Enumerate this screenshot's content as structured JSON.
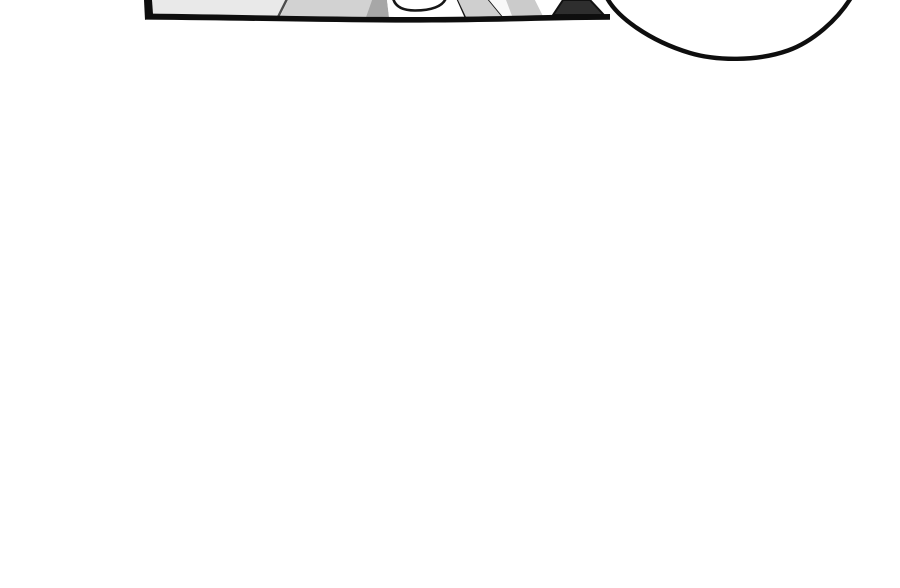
{
  "canvas": {
    "width": 900,
    "height": 588,
    "background": "#ffffff"
  },
  "palette": {
    "ink": "#0e0e0e",
    "floor_light_gray": "#e9e9e9",
    "floor_mid_gray": "#d2d2d2",
    "shadow_gray": "#a7a7a7",
    "strut_gray": "#cfcfcf",
    "wedge_dark": "#2e2e2e",
    "bubble_fill": "#ffffff"
  },
  "comic": {
    "panel_fragment": {
      "shapes": [
        {
          "name": "floor-panel-light",
          "tag": "polygon",
          "attrs": {
            "points": "151,0 288,0 280,17 151,17",
            "fill": "#e9e9e9"
          }
        },
        {
          "name": "floor-seam-line",
          "tag": "line",
          "attrs": {
            "x1": 287,
            "y1": -1,
            "x2": 278,
            "y2": 17,
            "stroke": "#4d4d4d",
            "stroke-width": 2.4
          }
        },
        {
          "name": "floor-panel-mid",
          "tag": "polygon",
          "attrs": {
            "points": "288,0 372,0 366,17 280,17",
            "fill": "#d2d2d2"
          }
        },
        {
          "name": "shadow-patch",
          "tag": "polygon",
          "attrs": {
            "points": "372,0 387,0 389,17 366,17",
            "fill": "#a7a7a7"
          }
        },
        {
          "name": "white-object-area",
          "tag": "polygon",
          "attrs": {
            "points": "387,0 458,0 466,17 389,17",
            "fill": "#ffffff"
          }
        },
        {
          "name": "round-object-bottom-arc",
          "tag": "path",
          "attrs": {
            "d": "M393,-2 C395,7 403,10.5 415,10.5 C431,10.5 443,6.5 446,-2",
            "fill": "none",
            "stroke": "#161616",
            "stroke-width": 2.6,
            "stroke-linecap": "round"
          }
        },
        {
          "name": "diagonal-edge-left",
          "tag": "line",
          "attrs": {
            "x1": 458,
            "y1": -1,
            "x2": 466,
            "y2": 17,
            "stroke": "#161616",
            "stroke-width": 3
          }
        },
        {
          "name": "gray-strut-left",
          "tag": "polygon",
          "attrs": {
            "points": "458,0 489,0 503,17 466,17",
            "fill": "#cfcfcf"
          }
        },
        {
          "name": "diagonal-edge-right",
          "tag": "line",
          "attrs": {
            "x1": 489,
            "y1": -1,
            "x2": 503,
            "y2": 16,
            "stroke": "#161616",
            "stroke-width": 3
          }
        },
        {
          "name": "white-sliver",
          "tag": "polygon",
          "attrs": {
            "points": "489,0 506,0 512,17 503,17",
            "fill": "#f8f8f8"
          }
        },
        {
          "name": "gray-strut-right",
          "tag": "polygon",
          "attrs": {
            "points": "506,0 535,0 543,16 512,16",
            "fill": "#cbcbcb"
          }
        },
        {
          "name": "white-gap",
          "tag": "polygon",
          "attrs": {
            "points": "535,0 563,0 553,16 543,16",
            "fill": "#ffffff"
          }
        },
        {
          "name": "dark-wedge",
          "tag": "polygon",
          "attrs": {
            "points": "563,0 590,0 604,15 553,15",
            "fill": "#2e2e2e",
            "stroke": "#111111",
            "stroke-width": 2,
            "stroke-linejoin": "round"
          }
        },
        {
          "name": "panel-border-bottom",
          "tag": "path",
          "attrs": {
            "d": "M145,13.5 C260,15 340,17.2 420,17 C500,16.8 556,14.2 610,14 L610,19.8 C556,20 500,22.4 420,22.6 C340,22.8 260,20.6 145,19.6 Z",
            "fill": "#0e0e0e"
          }
        },
        {
          "name": "panel-border-left",
          "tag": "polygon",
          "attrs": {
            "points": "144,0 152,0 153,14 145,20",
            "fill": "#0e0e0e"
          }
        }
      ]
    },
    "speech_bubble": {
      "path": "M606,-4 C616,17 650,41 690,53 C716,60.8 757,61.5 788,50.5 C812,42 838,20 852,-4 Z",
      "fill": "#ffffff",
      "stroke": "#0e0e0e",
      "stroke_width": 4.4
    }
  }
}
